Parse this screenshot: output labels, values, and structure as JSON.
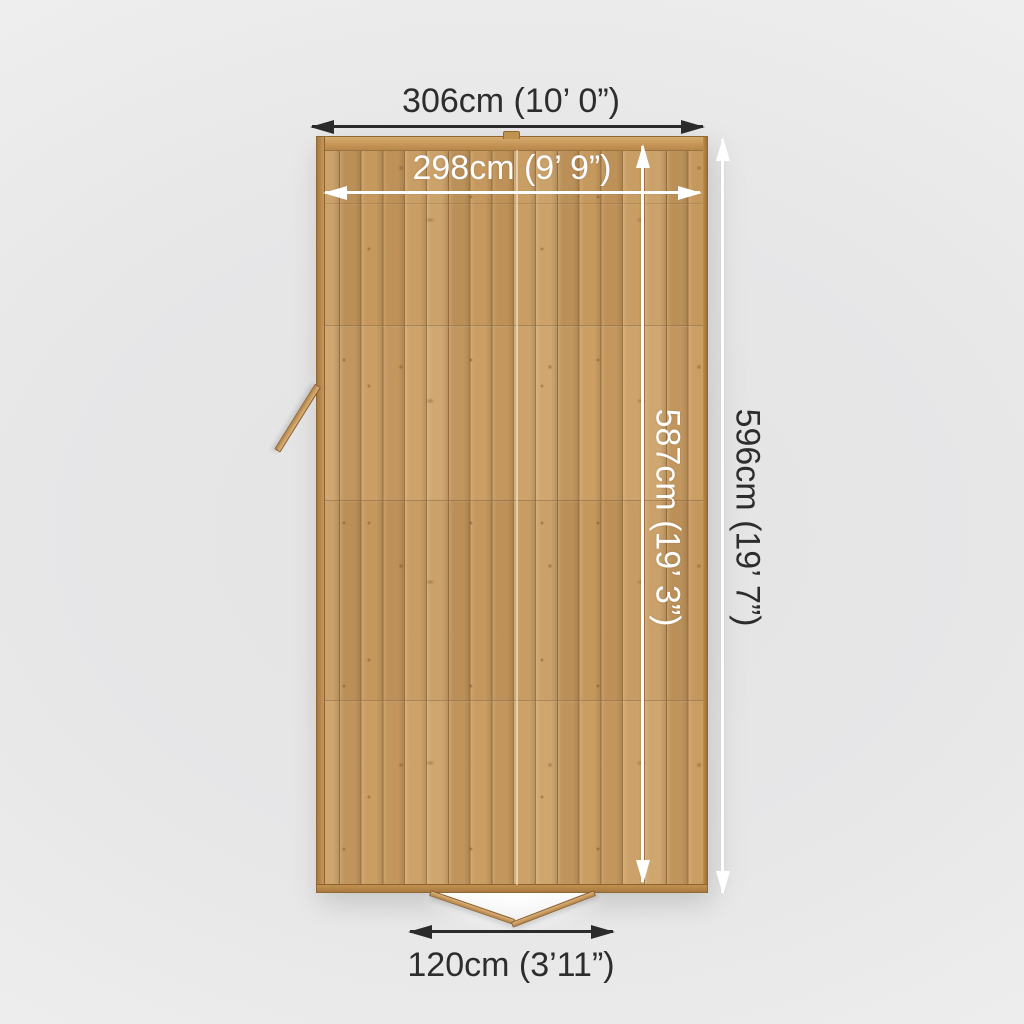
{
  "diagram": {
    "dims": {
      "outer_width": {
        "label": "306cm (10’ 0”)",
        "cm": 306,
        "imperial": "10’ 0”"
      },
      "inner_width": {
        "label": "298cm (9’ 9”)",
        "cm": 298,
        "imperial": "9’ 9”"
      },
      "inner_depth": {
        "label": "587cm (19’ 3”)",
        "cm": 587,
        "imperial": "19’ 3”"
      },
      "outer_depth": {
        "label": "596cm (19’ 7”)",
        "cm": 596,
        "imperial": "19’ 7”"
      },
      "door_width": {
        "label": "120cm (3’11”)",
        "cm": 120,
        "imperial": "3’11”"
      }
    },
    "colors": {
      "background": "#e8e8e9",
      "annotation_dark": "#2d2d2d",
      "annotation_light": "#ffffff",
      "wood_base": "#c99b5f",
      "wood_dark": "#a87c42",
      "wood_light": "#d6ac72"
    }
  }
}
